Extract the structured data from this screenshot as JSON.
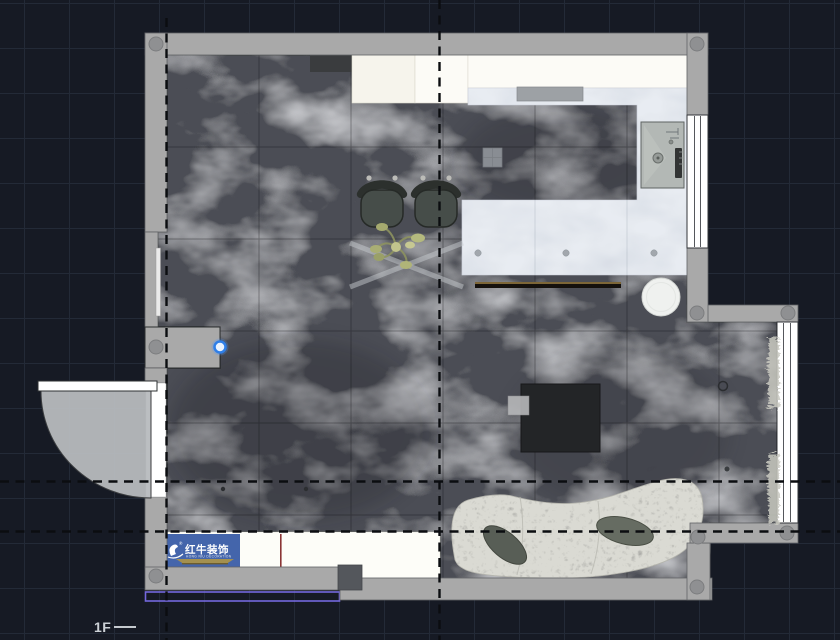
{
  "labels": {
    "floor": "1F"
  },
  "watermark": {
    "brand": "红牛装饰",
    "registered": "®",
    "tagline": "HONG NIU DECORATION",
    "panel_color": "#3c5fa8",
    "bar_color": "#a3904f"
  },
  "selection": {
    "handle_color": "#2f7fe8",
    "outline_color": "#7468dd"
  },
  "palette": {
    "background": "#161a24",
    "grid_line": "#232a37",
    "wall": "#a9a9a9",
    "floor_tile_dark_marble": "#4b4e54",
    "counter_marble_light": "#e8ecf2",
    "cabinet_white": "#fcfbf6",
    "sofa_boucle": "#dadad3",
    "chair_seat": "#464d49",
    "guide_dash": "#0b0d10"
  }
}
